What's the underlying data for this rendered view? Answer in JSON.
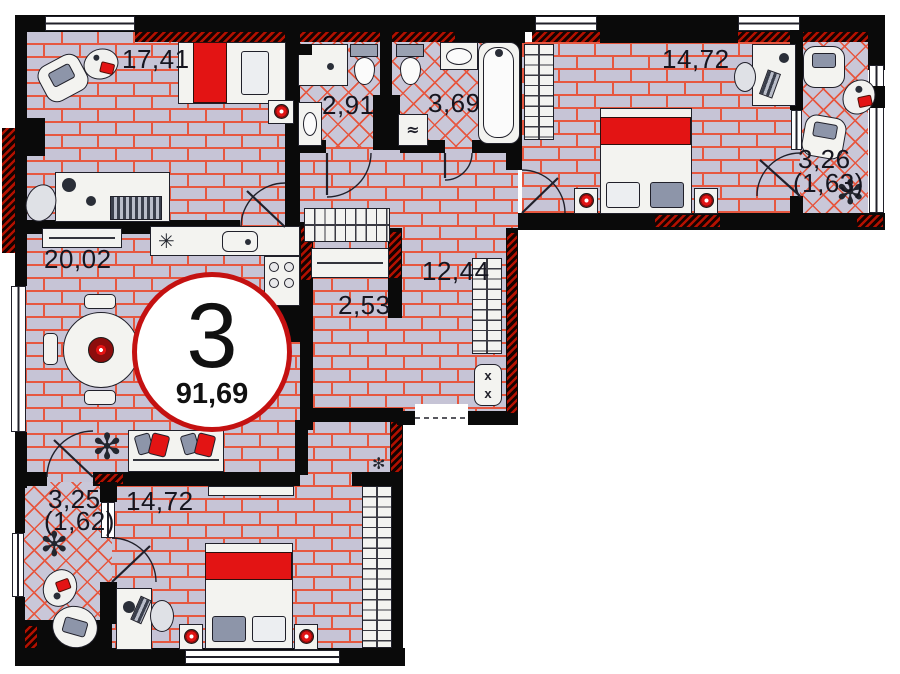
{
  "badge": {
    "rooms_count": "3",
    "total_area": "91,69"
  },
  "rooms": {
    "bedroom_top_left": {
      "area": "17,41"
    },
    "wc": {
      "area": "2,91"
    },
    "bathroom": {
      "area": "3,69"
    },
    "bedroom_top_right": {
      "area": "14,72"
    },
    "loggia_right": {
      "area": "3,26",
      "area_coef": "(1,63)"
    },
    "kitchen_living_room": {
      "area": "20,02"
    },
    "storage": {
      "area": "2,53"
    },
    "hallway": {
      "area": "12,44"
    },
    "balcony_bottom_left": {
      "area": "3,25",
      "area_coef": "(1,62)"
    },
    "bedroom_bottom": {
      "area": "14,72"
    }
  },
  "icons": {
    "plant": "✻",
    "kitchen_hob_star": "✳",
    "washing_machine": "≈",
    "electric_panel_x": "x"
  },
  "colors": {
    "floor_base": "#c6c4d6",
    "grout": "#e65740",
    "wall": "#0a0a0a",
    "hatch_red": "#b31000",
    "accent_red": "#e31414",
    "badge_ring": "#c41111",
    "furniture_outline": "#20202a"
  }
}
